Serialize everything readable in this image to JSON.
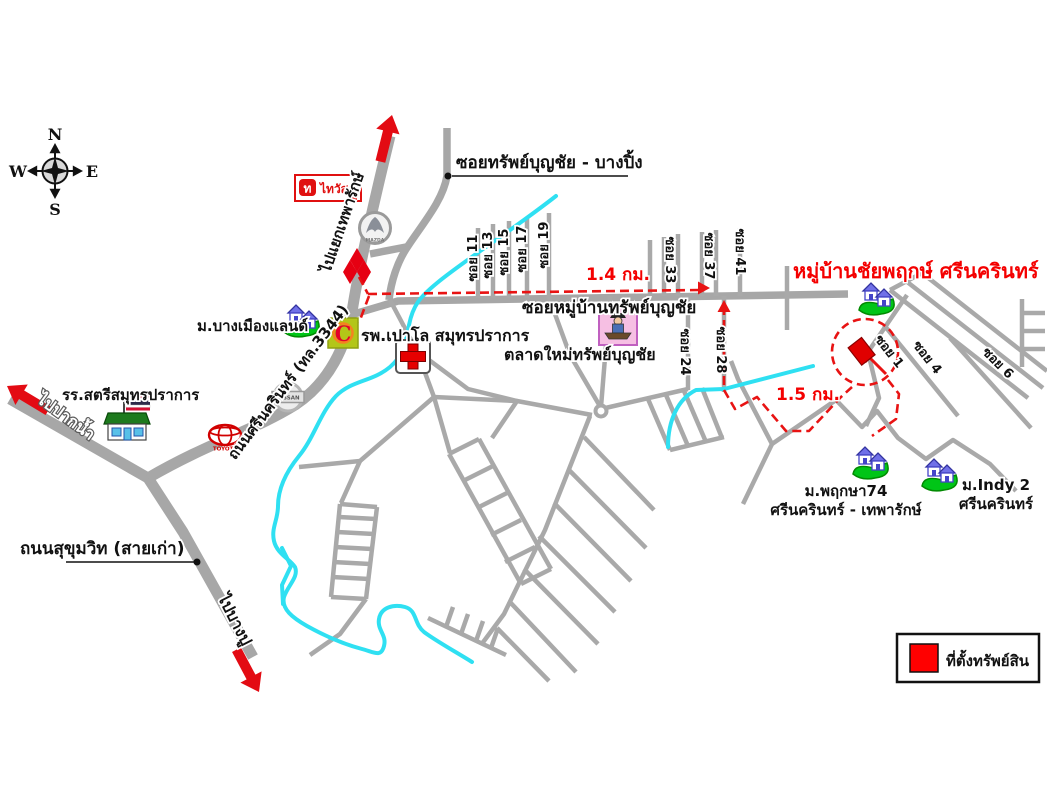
{
  "title": "หมู่บ้านชัยพฤกษ์ ศรีนครินทร์",
  "compass": {
    "north": "N",
    "south": "S",
    "east": "E",
    "west": "W"
  },
  "roads": {
    "srinakarin": "ถนนศรีนครินทร์ (ทล.3344)",
    "to_thepharak": "ไปแยกเทพารักษ์",
    "to_paknam": "ไปปากน้ำ",
    "to_bangpu": "ไปบางปู",
    "sukhumvit": "ถนนสุขุมวิท (สายเก่า)",
    "soi_bangping": "ซอยทรัพย์บุญชัย - บางปิ้ง",
    "soi_mueban": "ซอยหมู่บ้านทรัพย์บุญชัย"
  },
  "places": {
    "school": "รร.สตรีสมุทรปราการ",
    "bang_mueang_land": "ม.บางเมืองแลนด์",
    "hospital": "รพ.เปาโล สมุทรปราการ",
    "market": "ตลาดใหม่ทรัพย์บุญชัย",
    "pruksa74_line1": "ม.พฤกษา74",
    "pruksa74_line2": "ศรีนครินทร์ - เทพารักษ์",
    "indy2_line1": "ม.Indy 2",
    "indy2_line2": "ศรีนครินทร์",
    "thai_watsadu": "ไทวัสดุ",
    "thai_watsadu_logo": "ท"
  },
  "sois": {
    "s11": "ซอย 11",
    "s13": "ซอย 13",
    "s15": "ซอย 15",
    "s17": "ซอย 17",
    "s19": "ซอย 19",
    "s33": "ซอย 33",
    "s37": "ซอย 37",
    "s41": "ซอย 41",
    "s24": "ซอย 24",
    "s28": "ซอย 28",
    "s1": "ซอย 1",
    "s4": "ซอย 4",
    "s6": "ซอย 6"
  },
  "distances": {
    "d1": "1.4 กม.",
    "d2": "1.5 กม."
  },
  "legend": {
    "label": "ที่ตั้งทรัพย์สิน"
  },
  "brands": {
    "mazda": "MAZDA",
    "toyota": "TOYOTA",
    "nissan": "NISSAN",
    "bigc": "C"
  },
  "colors": {
    "route": "#e81313",
    "road": "#a7a7a7",
    "canal": "#2fe0f2",
    "title": "#ff0000",
    "legend_marker": "#ff0000"
  }
}
